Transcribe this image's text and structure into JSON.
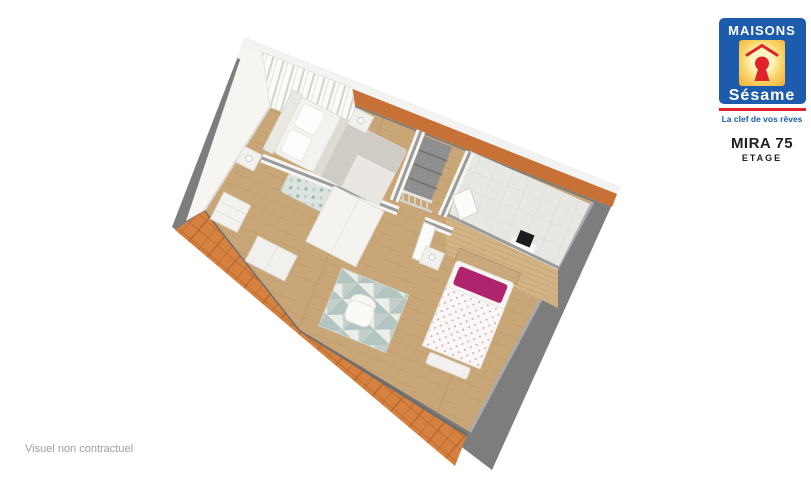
{
  "branding": {
    "brand_top": "MAISONS",
    "brand_script": "Sésame",
    "tagline": "La clef de vos rêves",
    "colors": {
      "blue": "#1d5cad",
      "red": "#e02229",
      "yellow_center": "#fdf6c0",
      "yellow_edge": "#f2a93b",
      "white": "#ffffff"
    }
  },
  "plan_header": {
    "title": "MIRA 75",
    "subtitle": "ETAGE",
    "text_color": "#1f1f1f"
  },
  "footer": {
    "disclaimer": "Visuel non contractuel",
    "text_color": "#9aa0a5"
  },
  "floorplan": {
    "view": "3d-cutaway-floor-plan",
    "colors": {
      "outer_wall": "#7d7d7d",
      "wall_cap": "#9b9b9b",
      "inner_wall": "#f6f5f2",
      "eave_band": "#f3f3f1",
      "roof_tile": "#d6813f",
      "roof_grout": "#b5672e",
      "ridge_orange": "#c87137",
      "floor_wood": "#c9a678",
      "plank_line": "#b8935f",
      "bath_floor": "#e7e7e3",
      "bath_grid": "#d9d9d5",
      "wood_panel": "#d3b384",
      "wood_panel_line": "#bc9e71",
      "bed_linen": "#f4f2ee",
      "blanket_gray": "#cfccc6",
      "accent_magenta": "#b0246e",
      "rug_teal": "#a9bfb9",
      "rug_light": "#eceeea",
      "stair_void": "#8f8f8f",
      "appliance_black": "#1c1c1c"
    },
    "elements": [
      "tiled-roof-slope",
      "master-double-bed",
      "nightstand-left",
      "nightstand-right",
      "leaf-pattern-rug",
      "dresser",
      "shelf-unit",
      "wardrobe",
      "staircase-with-railing",
      "bathroom-tiled-floor",
      "wall-appliance",
      "wood-panel-headboard-wall",
      "single-bed",
      "bedside-table",
      "triangle-pattern-rug",
      "chair",
      "bench"
    ]
  }
}
